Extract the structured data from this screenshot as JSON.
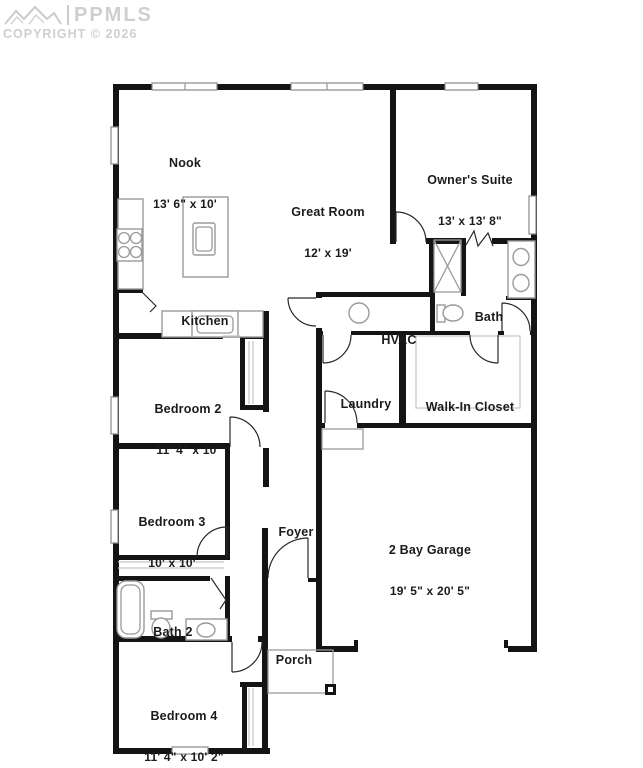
{
  "watermark": {
    "logo_icon": "mountains-icon",
    "brand": "PPMLS",
    "copyright": "COPYRIGHT © 2026"
  },
  "rooms": {
    "nook": {
      "name": "Nook",
      "dims": "13' 6\" x 10'"
    },
    "great_room": {
      "name": "Great Room",
      "dims": "12' x 19'"
    },
    "owners_suite": {
      "name": "Owner's Suite",
      "dims": "13' x 13' 8\""
    },
    "kitchen": {
      "name": "Kitchen"
    },
    "hvac": {
      "name": "HVAC"
    },
    "bath": {
      "name": "Bath"
    },
    "bedroom2": {
      "name": "Bedroom 2",
      "dims": "11' 4\" x 10'"
    },
    "laundry": {
      "name": "Laundry"
    },
    "walk_in_closet": {
      "name": "Walk-In Closet"
    },
    "bedroom3": {
      "name": "Bedroom 3",
      "dims": "10' x 10'"
    },
    "foyer": {
      "name": "Foyer"
    },
    "garage": {
      "name": "2 Bay Garage",
      "dims": "19' 5\" x 20' 5\""
    },
    "bath2": {
      "name": "Bath 2"
    },
    "porch": {
      "name": "Porch"
    },
    "bedroom4": {
      "name": "Bedroom 4",
      "dims": "11' 4\" x 10' 2\""
    }
  },
  "icons": {
    "mountains": "zigzag-peaks-outline",
    "stove": "4-burner-circles",
    "toilet": "tank-and-bowl-ellipse",
    "shower": "x-crossed-box",
    "sink": "oval-basin",
    "hvac_unit": "circle",
    "porch_post": "filled-square"
  },
  "colors": {
    "wall": "#141414",
    "fixture": "#9a9a9a",
    "light_fixture": "#c4c4c4",
    "door_arc": "#2a2a2a",
    "watermark": "#cbcbcb",
    "text": "#1b1b1b",
    "background": "#ffffff"
  }
}
